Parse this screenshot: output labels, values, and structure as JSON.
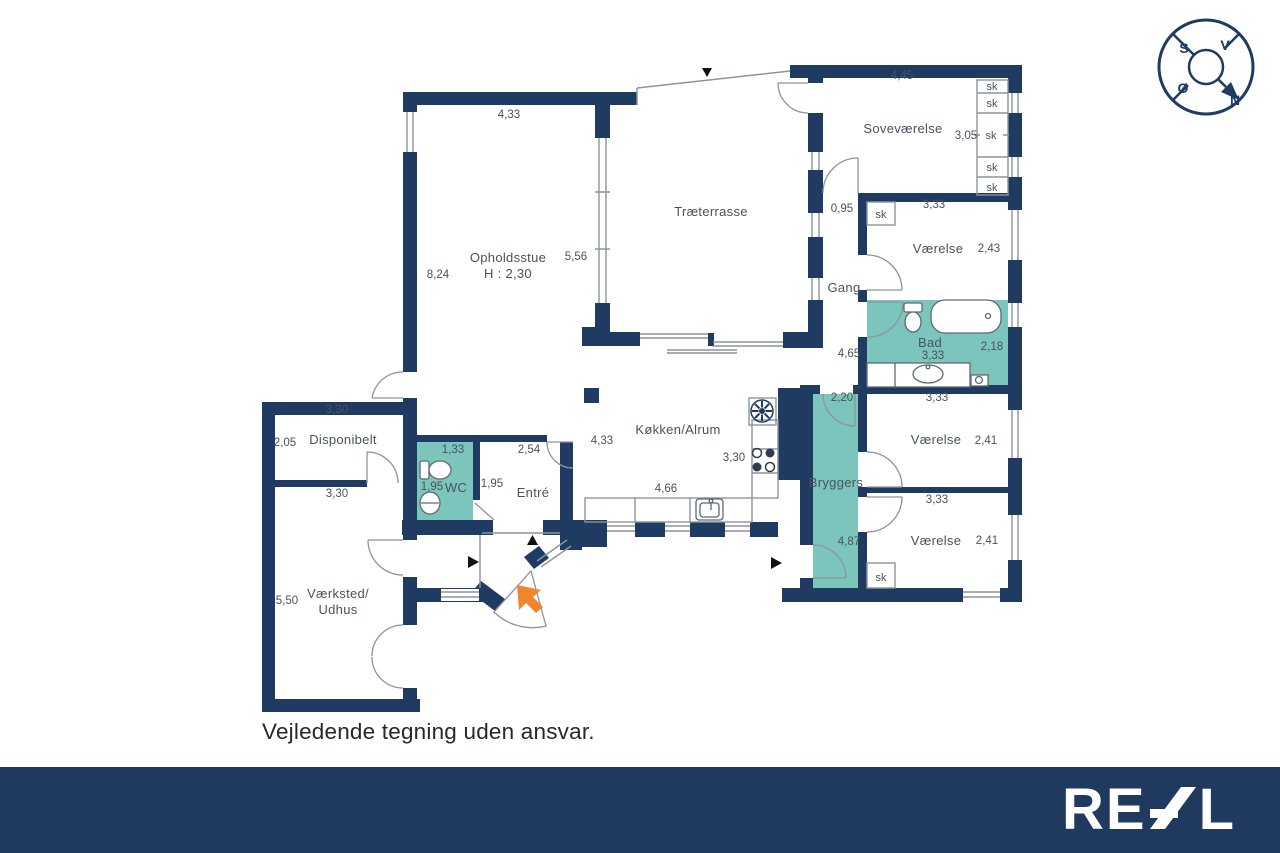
{
  "colors": {
    "wall": "#1F3B62",
    "highlight": "#7CC5BC",
    "text": "#49525C",
    "thin": "#8C949C",
    "fixture": "#5E6973",
    "marker": "#111111",
    "arrow": "#F0862E",
    "footer_bg": "#1F3A5E",
    "logo": "#FFFFFF"
  },
  "compass": {
    "south": "S",
    "west": "V",
    "east": "Ø",
    "north": "N"
  },
  "rooms": {
    "opholdsstue": "Opholdsstue",
    "opholdsstue_height": "H : 2,30",
    "traeterrasse": "Træterrasse",
    "sovevaerelse": "Soveværelse",
    "vaerelse_ne": "Værelse",
    "vaerelse_e": "Værelse",
    "vaerelse_se": "Værelse",
    "gang": "Gang",
    "bad": "Bad",
    "bryggers": "Bryggers",
    "koekken": "Køkken/Alrum",
    "entre": "Entré",
    "wc": "WC",
    "disponibelt": "Disponibelt",
    "vaerksted_line1": "Værksted/",
    "vaerksted_line2": "Udhus",
    "closet": "sk"
  },
  "dimensions": {
    "opholdsstue_width": "4,33",
    "opholdsstue_depth": "8,24",
    "opholdsstue_east": "5,56",
    "sovevaerelse_width": "4,45",
    "sovevaerelse_depth": "3,05",
    "gang_width": "0,95",
    "gang_length": "4,65",
    "vaerelse_ne_width": "3,33",
    "vaerelse_ne_depth": "2,43",
    "bad_width": "3,33",
    "bad_depth": "2,18",
    "bryggers_width": "2,20",
    "bryggers_length": "4,87",
    "vaerelse_e_width": "3,33",
    "vaerelse_e_depth": "2,41",
    "vaerelse_se_width": "3,33",
    "vaerelse_se_depth": "2,41",
    "koekken_west": "4,33",
    "koekken_east": "3,30",
    "koekken_south": "4,66",
    "entre_width": "2,54",
    "entre_side": "1,95",
    "wc_width": "1,33",
    "wc_depth": "1,95",
    "disponibelt_width": "3,30",
    "disponibelt_depth": "2,05",
    "vaerksted_width": "3,30",
    "vaerksted_depth": "5,50"
  },
  "disclaimer": "Vejledende tegning uden ansvar.",
  "footer": {
    "logo_text": "REAL",
    "logo_r": "R",
    "logo_e": "E",
    "logo_l": "L"
  }
}
